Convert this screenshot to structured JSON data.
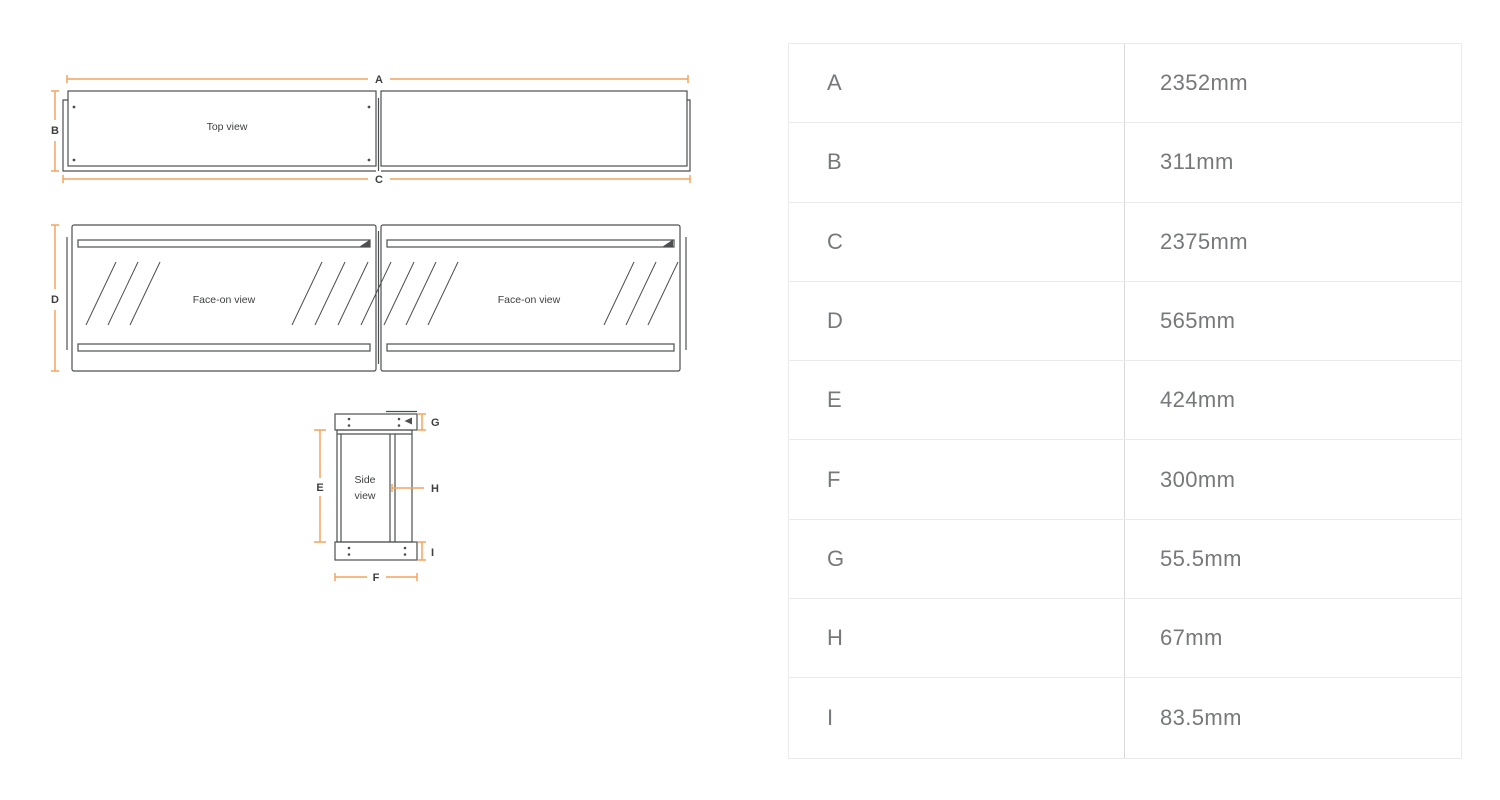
{
  "colors": {
    "accent": "#F2A45F",
    "line": "#4E4F51",
    "ink": "#3E3F41",
    "text": "#77787B",
    "border": "#ebebeb",
    "divider": "#d9d9d9",
    "bg": "#ffffff"
  },
  "diagram": {
    "views": {
      "top": "Top view",
      "face": "Face-on view",
      "side_line1": "Side",
      "side_line2": "view"
    }
  },
  "table": {
    "rows": [
      {
        "label": "A",
        "value": "2352mm"
      },
      {
        "label": "B",
        "value": "311mm"
      },
      {
        "label": "C",
        "value": "2375mm"
      },
      {
        "label": "D",
        "value": "565mm"
      },
      {
        "label": "E",
        "value": "424mm"
      },
      {
        "label": "F",
        "value": "300mm"
      },
      {
        "label": "G",
        "value": "55.5mm"
      },
      {
        "label": "H",
        "value": "67mm"
      },
      {
        "label": "I",
        "value": "83.5mm"
      }
    ]
  }
}
